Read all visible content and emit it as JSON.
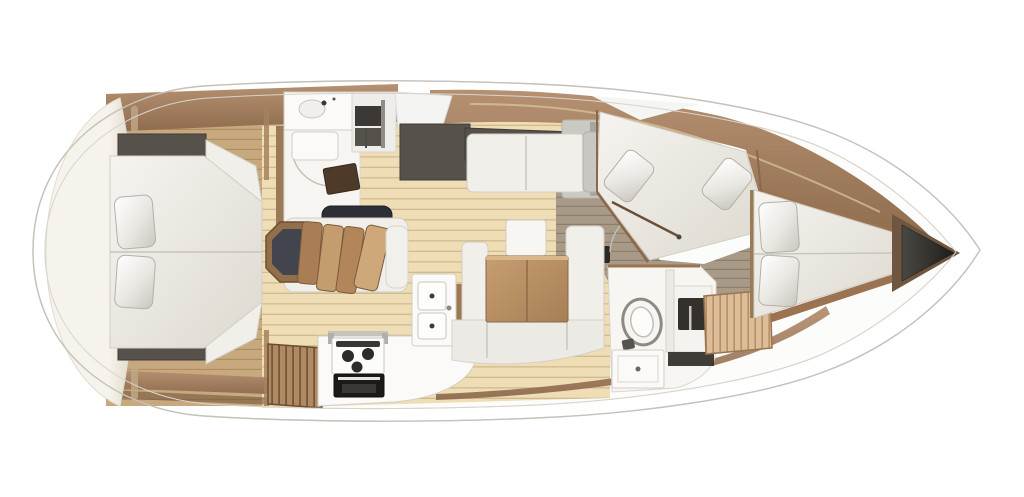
{
  "scene": {
    "title": "Sailing yacht interior floor plan, top-down 3D render; pointed bow with dark anchor locker to the right, rounded stern to the left",
    "orientation": {
      "bow": "right",
      "stern": "left"
    },
    "areas": [
      {
        "id": "aft-owner-cabin",
        "desc": "Full-beam aft cabin: tapered island double berth with two pillows, dark wardrobe units fore and aft, cream transom pod behind the headboard"
      },
      {
        "id": "forward-head-port",
        "desc": "Port head compartment: washbasin counter with faucet, open shelving, shower floor with dark teak mat, door swing arc"
      },
      {
        "id": "dinette-port",
        "desc": "Dinette: convertible table with four fanned wooden leaves, navy bench cushion, hexagonal wood-framed end seat"
      },
      {
        "id": "settee-port",
        "desc": "Straight two-seat settee with grey armrest and side cabinet, dark lockers outboard"
      },
      {
        "id": "u-settee-starboard",
        "desc": "U-shaped settee around a rectangular wooden saloon table, with white stool and small dark control panel"
      },
      {
        "id": "galley-starboard",
        "desc": "L-shaped galley: twin square sinks, gimballed three-burner gas stove with dark oven, curved white worktop"
      },
      {
        "id": "companionway-steps",
        "desc": "Wood-slat steps at the aft starboard side"
      },
      {
        "id": "head-starboard",
        "desc": "Second head: oval toilet, dark washbasin recess with faucet, vanity drawer unit"
      },
      {
        "id": "guest-cabin-forward-port",
        "desc": "Guest cabin with diagonal double berth and two angled pillows, sliding door rail"
      },
      {
        "id": "forward-cabin",
        "desc": "Bow cabin: tapered V-berth with two pillows and slatted wooden bench"
      },
      {
        "id": "anchor-locker",
        "desc": "Dark triangular chain locker at the bow tip framed in wood"
      }
    ]
  },
  "colors": {
    "hull_line": "#c6c2ba",
    "deck_line": "#d8d4cc",
    "floor_cream": "#eeddb5",
    "floor_cream_line": "#c9b285",
    "floor_taupe": "#a89a87",
    "floor_taupe_line": "#857a68",
    "wood_dark": "#6b4e35",
    "wood_mid": "#9b7351",
    "wood_warm": "#b08a62",
    "wood_pale": "#dcbd98",
    "cabinet_dark": "#56514b",
    "upholstery": "#f1efe9",
    "navy": "#2c2f36",
    "table_wood": "#bb9066",
    "appliance_dark": "#1c1a18",
    "bow_locker": "#2e2c28",
    "dome_hi": "#f6f3ec",
    "dome_lo": "#dcd5c4",
    "stroke_soft": "#d2cec5"
  }
}
